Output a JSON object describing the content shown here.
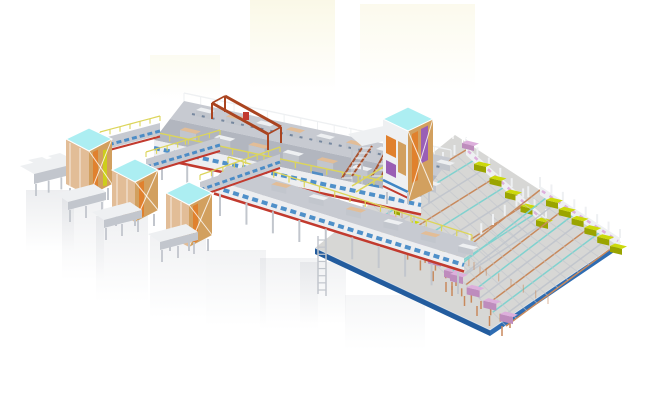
{
  "meta": {
    "description": "Isometric 3D CAD rendering of an automated factory conveyor line with storage towers, elevated conveyor galleries, an overhead crane and two large curing-rack fields on a blue-edged concrete floor slab",
    "canvas": {
      "width": 650,
      "height": 418
    },
    "has_text": false
  },
  "scene": {
    "components": [
      {
        "name": "far-left-outfeed-conveyor"
      },
      {
        "name": "storage-tower-1"
      },
      {
        "name": "storage-tower-2"
      },
      {
        "name": "storage-tower-3"
      },
      {
        "name": "tall-storage-tower"
      },
      {
        "name": "elevated-conveyor-spine"
      },
      {
        "name": "front-conveyor-gallery"
      },
      {
        "name": "branch-conveyor-1"
      },
      {
        "name": "branch-conveyor-2"
      },
      {
        "name": "branch-conveyor-3"
      },
      {
        "name": "overhead-crane"
      },
      {
        "name": "access-stairs"
      },
      {
        "name": "access-ladder"
      },
      {
        "name": "rack-field-1"
      },
      {
        "name": "rack-field-2"
      },
      {
        "name": "yellow-process-machines"
      },
      {
        "name": "pink-process-machines"
      },
      {
        "name": "factory-floor-slab"
      }
    ]
  },
  "palette": {
    "bg": "#ffffff",
    "tint": "#f5f1cd",
    "shadow": "#a9aeb8",
    "floor_top": "#d7d7d5",
    "floor_edge": "#2e6cb2",
    "floor_edge_dark": "#235c9e",
    "deck1": "#c7cad1",
    "deck2": "#b2b6bf",
    "face": "#edeef0",
    "steel": "#eef0f2",
    "steel_shade": "#c2c6cd",
    "steel_dark": "#9ba0a9",
    "rail_yellow": "#dcd55a",
    "rail_yellow_deep": "#b7b13c",
    "red": "#c23a2e",
    "crane": "#aa4420",
    "blue": "#3f86c5",
    "navy": "#2b4a70",
    "teal": "#7fd2cf",
    "cyan": "#aceef2",
    "tan": "#d2a05f",
    "tan_dark": "#b07c3e",
    "copper": "#c8895c",
    "copper_light": "#e2bd97",
    "orange": "#e0812e",
    "purple": "#9a5fb5",
    "machine_yellow": "#ccd90b",
    "machine_yellow_dark": "#9aa400",
    "machine_pink": "#ddafdc",
    "machine_pink_dark": "#be8cbd",
    "stair_red": "#a8522e"
  }
}
